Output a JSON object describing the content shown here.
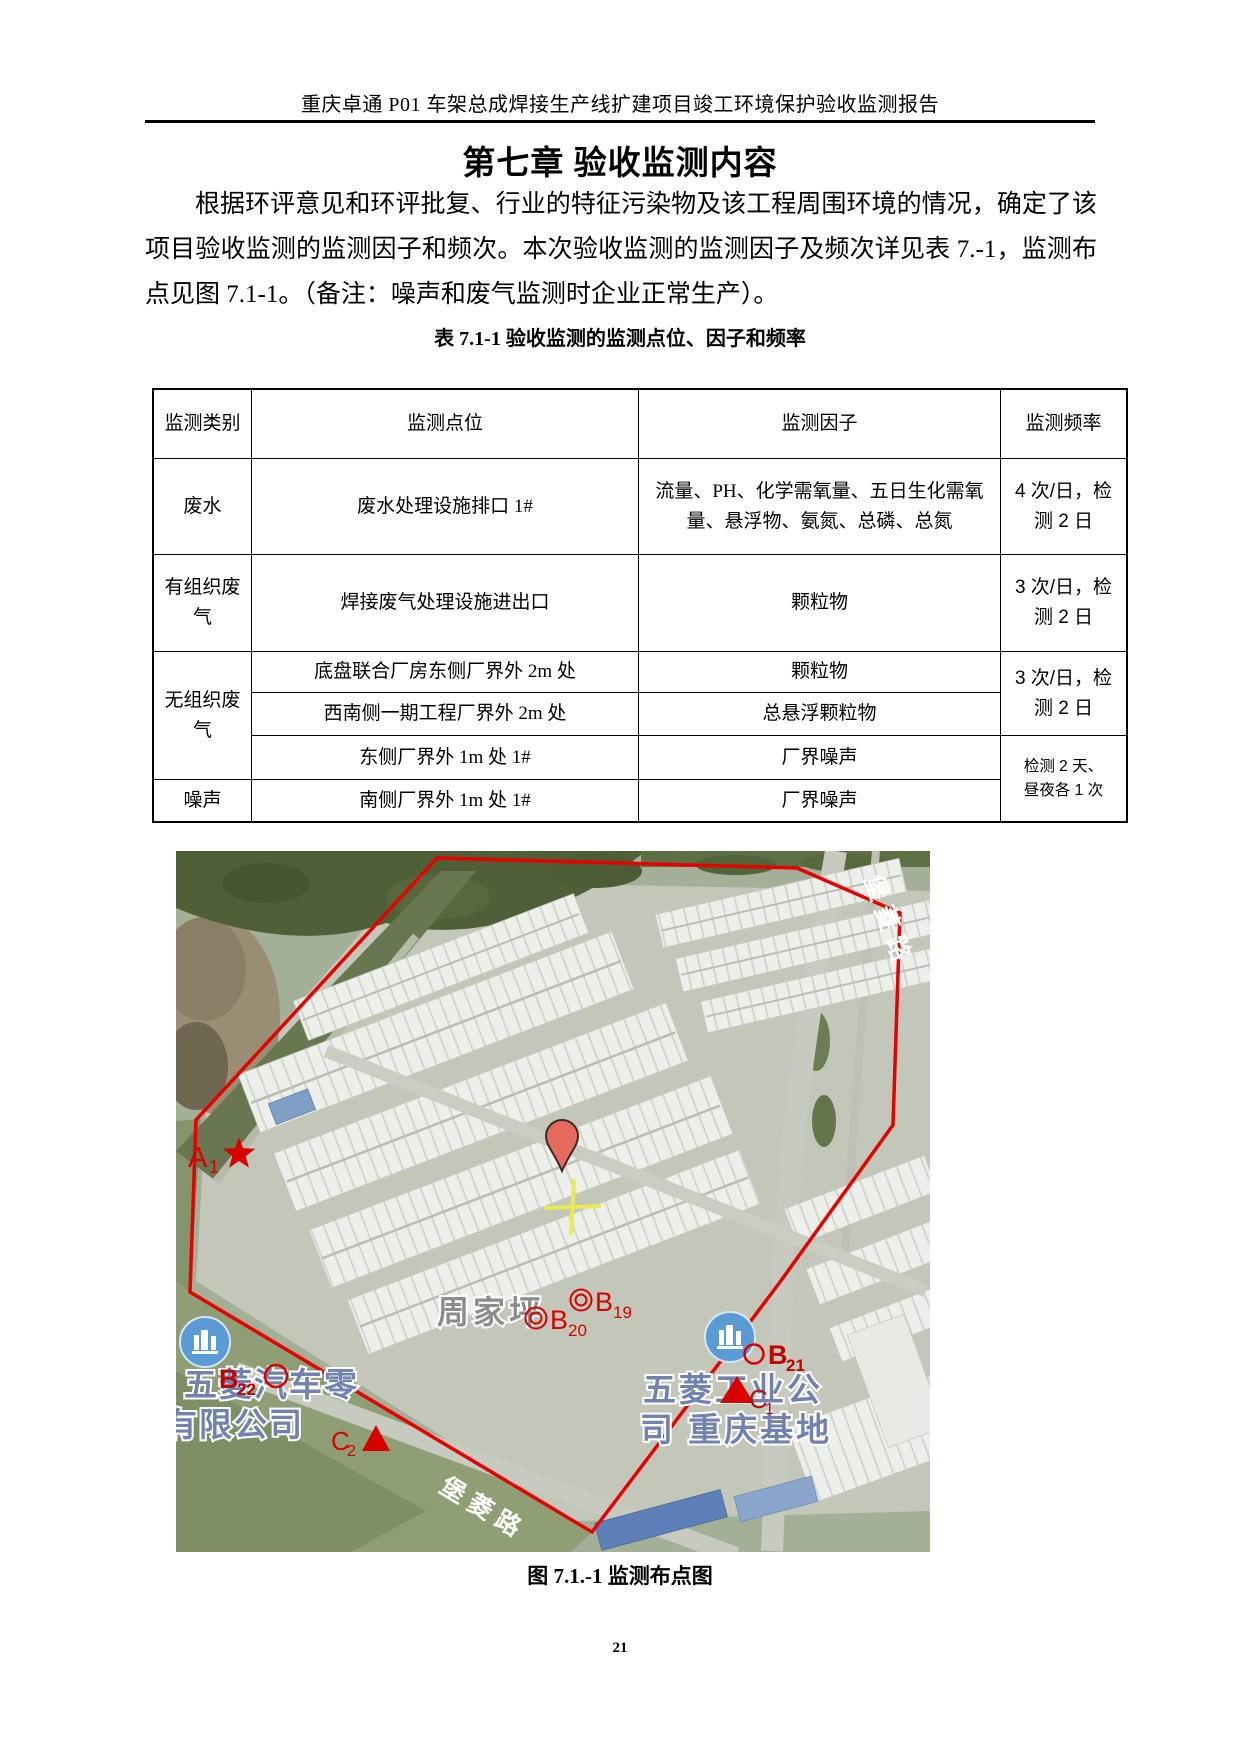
{
  "document": {
    "header_title": "重庆卓通 P01 车架总成焊接生产线扩建项目竣工环境保护验收监测报告",
    "chapter_title": "第七章  验收监测内容",
    "paragraph": "根据环评意见和环评批复、行业的特征污染物及该工程周围环境的情况，确定了该项目验收监测的监测因子和频次。本次验收监测的监测因子及频次详见表 7.-1，监测布点见图 7.1-1。（备注：噪声和废气监测时企业正常生产）。",
    "page_number": "21"
  },
  "table": {
    "caption": "表 7.1-1    验收监测的监测点位、因子和频率",
    "headers": {
      "category": "监测类别",
      "location": "监测点位",
      "factor": "监测因子",
      "frequency": "监测频率"
    },
    "wastewater": {
      "category": "废水",
      "location": "废水处理设施排口 1#",
      "factor": "流量、PH、化学需氧量、五日生化需氧量、悬浮物、氨氮、总磷、总氮",
      "frequency": "4 次/日，检测 2 日"
    },
    "organized_gas": {
      "category": "有组织废气",
      "location": "焊接废气处理设施进出口",
      "factor": "颗粒物",
      "frequency": "3 次/日，检测 2 日"
    },
    "fugitive_gas": {
      "category": "无组织废气",
      "row1_location": "底盘联合厂房东侧厂界外 2m 处",
      "row1_factor": "颗粒物",
      "row2_location": "西南侧一期工程厂界外 2m 处",
      "row2_factor": "总悬浮颗粒物",
      "row3_location": "东侧厂界外 1m 处 1#",
      "row3_factor": "厂界噪声",
      "frequency": "3 次/日，检测 2 日"
    },
    "noise": {
      "category": "噪声",
      "location": "南侧厂界外 1m 处 1#",
      "factor": "厂界噪声",
      "frequency_line1": "检测 2 天、",
      "frequency_line2": "昼夜各 1 次"
    }
  },
  "figure": {
    "caption": "图 7.1.-1 监测布点图",
    "map": {
      "markers": {
        "a1": {
          "label": "A",
          "sub": "1"
        },
        "b19": {
          "label": "B",
          "sub": "19"
        },
        "b20": {
          "label": "B",
          "sub": "20"
        },
        "b21": {
          "label": "B",
          "sub": "21"
        },
        "b22": {
          "label": "B",
          "sub": "22"
        },
        "c1": {
          "label": "C",
          "sub": "1"
        },
        "c2": {
          "label": "C",
          "sub": "2"
        }
      },
      "labels": {
        "village": "周家坪",
        "company_right_line1": "五菱工业公",
        "company_right_line2": "司 重庆基地",
        "company_left_line1": "五菱汽车零",
        "company_left_line2": "有限公司",
        "road_top": "堡菱路",
        "road_bottom": "堡菱路"
      },
      "colors": {
        "boundary_red": "#e60000",
        "marker_red": "#d90000",
        "company_blue": "#7282ae",
        "village_gray": "#8b8d8c",
        "poi_blue": "#5b9bd5"
      }
    }
  }
}
